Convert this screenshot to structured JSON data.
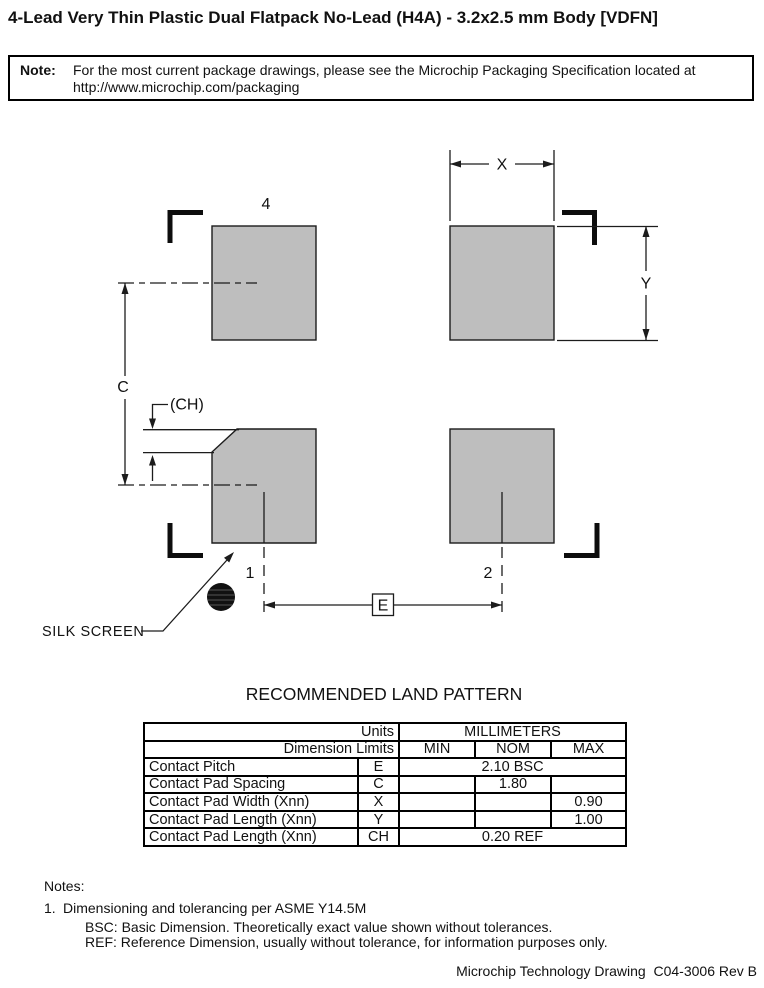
{
  "page": {
    "title": "4-Lead Very Thin Plastic Dual Flatpack No-Lead (H4A) - 3.2x2.5 mm Body [VDFN]",
    "footer": "Microchip Technology Drawing  C04-3006 Rev B"
  },
  "note_box": {
    "label": "Note:",
    "line1": "For the most current package drawings, please see the Microchip Packaging Specification located at",
    "line2": "http://www.microchip.com/packaging"
  },
  "drawing": {
    "pad4_label": "4",
    "pin1_label": "1",
    "pin2_label": "2",
    "dim_x_label": "X",
    "dim_y_label": "Y",
    "dim_c_label": "C",
    "dim_ch_label": "(CH)",
    "dim_e_label": "E",
    "silk_screen_label": "SILK SCREEN",
    "pad_fill_color": "#bebebe",
    "line_color": "#1c1c1c"
  },
  "land_pattern": {
    "heading": "RECOMMENDED LAND PATTERN",
    "table": {
      "units_label": "Units",
      "units_value": "MILLIMETERS",
      "dimension_limits_label": "Dimension Limits",
      "col_min": "MIN",
      "col_nom": "NOM",
      "col_max": "MAX",
      "rows": [
        {
          "name": "Contact Pitch",
          "symbol": "E",
          "value": "2.10 BSC"
        },
        {
          "name": "Contact Pad Spacing",
          "symbol": "C",
          "min": "",
          "nom": "1.80",
          "max": ""
        },
        {
          "name": "Contact Pad Width (Xnn)",
          "symbol": "X",
          "min": "",
          "nom": "",
          "max": "0.90"
        },
        {
          "name": "Contact Pad Length (Xnn)",
          "symbol": "Y",
          "min": "",
          "nom": "",
          "max": "1.00"
        },
        {
          "name": "Contact Pad Length (Xnn)",
          "symbol": "CH",
          "value": "0.20 REF"
        }
      ]
    }
  },
  "notes": {
    "heading": "Notes:",
    "item1_number": "1.",
    "item1_text": "Dimensioning and tolerancing per ASME Y14.5M",
    "bsc_text": "BSC: Basic Dimension. Theoretically exact value shown without tolerances.",
    "ref_text": "REF: Reference Dimension, usually without tolerance, for information purposes only."
  }
}
